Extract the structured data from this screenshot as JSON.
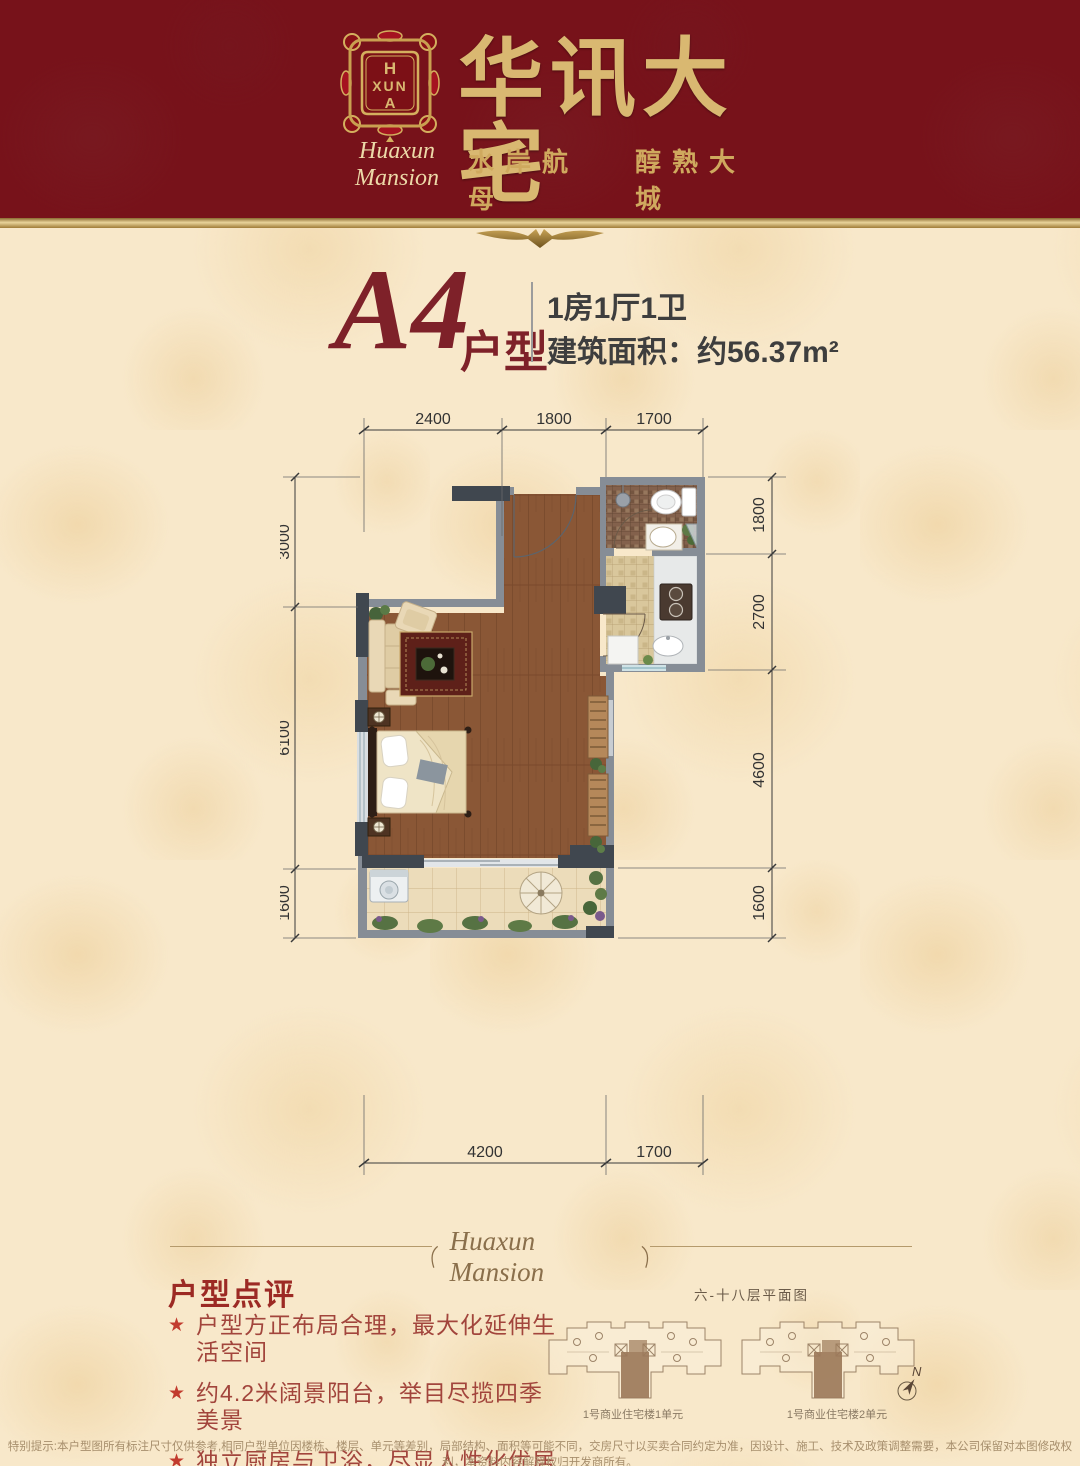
{
  "header": {
    "logo": {
      "monogram": [
        "H",
        "XUN",
        "A"
      ]
    },
    "brand_script": "Huaxun Mansion",
    "title": "华讯大宅",
    "subtitle_left": "水岸航母",
    "subtitle_right": "醇熟大城"
  },
  "unit": {
    "code": "A4",
    "suffix": "户型",
    "layout": "1房1厅1卫",
    "area": "建筑面积：约56.37m²"
  },
  "floor_plan": {
    "dims_top": [
      "2400",
      "1800",
      "1700"
    ],
    "dims_left": [
      "3000",
      "6100",
      "1600"
    ],
    "dims_right": [
      "1800",
      "2700",
      "4600",
      "1600"
    ],
    "dims_bottom": [
      "4200",
      "1700"
    ]
  },
  "divider": {
    "script": "Huaxun Mansion"
  },
  "review": {
    "heading": "户型点评",
    "marker": "★",
    "bullets": [
      "户型方正布局合理，最大化延伸生活空间",
      "约4.2米阔景阳台，举目尽揽四季美景",
      "独立厨房与卫浴，尽显人性化优居设计"
    ]
  },
  "keyplan": {
    "title": "六-十八层平面图",
    "labels": [
      "1号商业住宅楼1单元",
      "1号商业住宅楼2单元"
    ],
    "north_label": "N"
  },
  "footer": {
    "disclaimer": "特别提示:本户型图所有标注尺寸仅供参考,相同户型单位因楼栋、楼层、单元等差别，局部结构、面积等可能不同，交房尺寸以买卖合同约定为准，因设计、施工、技术及政策调整需要，本公司保留对本图修改权利，本资料内容解释权归开发商所有。"
  },
  "colors": {
    "header_maroon": "#77121a",
    "gold": "#d9b871",
    "cream_bg": "#f8e8ca",
    "accent_red": "#9c2a24",
    "wall_gray": "#868d96",
    "wall_dark": "#40474f",
    "wood_floor": "#8a5736"
  }
}
